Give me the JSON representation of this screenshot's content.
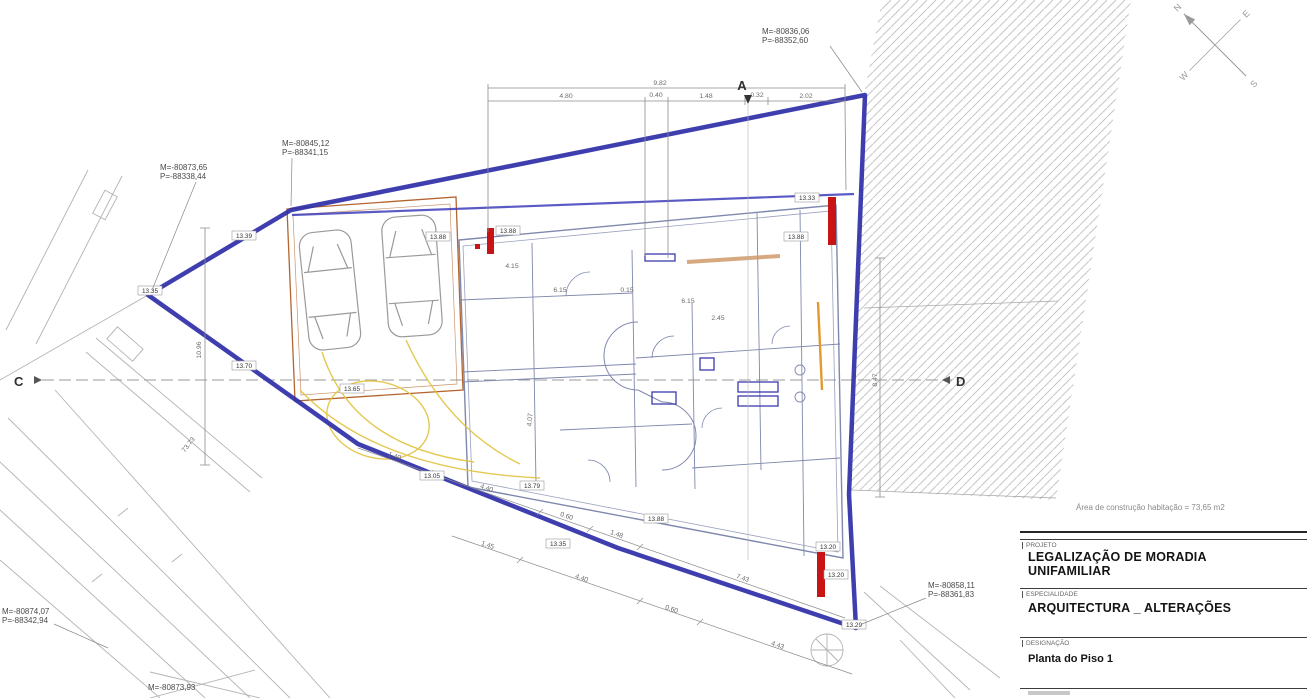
{
  "title_block": {
    "field1_label": "PROJETO",
    "field1_value_line1": "LEGALIZAÇÃO DE MORADIA",
    "field1_value_line2": "UNIFAMILIAR",
    "field2_label": "ESPECIALIDADE",
    "field2_value": "ARQUITECTURA _ ALTERAÇÕES",
    "field3_label": "DESIGNAÇÃO",
    "field3_value": "Planta do Piso 1"
  },
  "notes": {
    "construction_area": "Área de construção habitação = 73,65 m2"
  },
  "survey_points": {
    "top_right": {
      "m": "M=-80836,06",
      "p": "P=-88352,60"
    },
    "upper_left": {
      "m": "M=-80845,12",
      "p": "P=-88341,15"
    },
    "far_left": {
      "m": "M=-80873,65",
      "p": "P=-88338,44"
    },
    "bottom_right": {
      "m": "M=-80858,11",
      "p": "P=-88361,83"
    },
    "bottom_left": {
      "m": "M=-80874,07",
      "p": "P=-88342,94"
    },
    "bottom_edge": {
      "m": "M=-80873,93"
    }
  },
  "section_markers": {
    "a": "A",
    "c": "C",
    "d": "D"
  },
  "compass": {
    "n": "N",
    "e": "E",
    "s": "S",
    "w": "W"
  },
  "dims": {
    "top_total": "9.82",
    "seg1": "4.80",
    "seg2": "0.40",
    "seg3": "1.48",
    "seg4": "0.32",
    "seg5": "2.02",
    "right_v": "8.47",
    "left_v": "10.96",
    "road": "73.73",
    "c1a": "1.40",
    "c1b": "4.40",
    "c1c": "0.60",
    "c1d": "1.48",
    "c1e": "7.43",
    "c2a": "1.45",
    "c2b": "4.40",
    "c2c": "0.60",
    "c2d": "4.43",
    "i1": "4.15",
    "i2": "6.15",
    "i3": "0.15",
    "i4": "6.15",
    "i5": "2.45",
    "i6": "4.07"
  },
  "elevations": [
    "13.35",
    "13.39",
    "13.88",
    "13.88",
    "13.70",
    "13.65",
    "13.05",
    "13.79",
    "13.35",
    "13.88",
    "13.20",
    "13.20",
    "13.29",
    "13.33",
    "13.88"
  ],
  "colors": {
    "boundary_blue": "#2e2ea8",
    "new_wall_red": "#c81414",
    "garage_orange": "#b4652f",
    "swing_yellow": "#e2c33f",
    "wall_blue": "#7f88ad"
  }
}
